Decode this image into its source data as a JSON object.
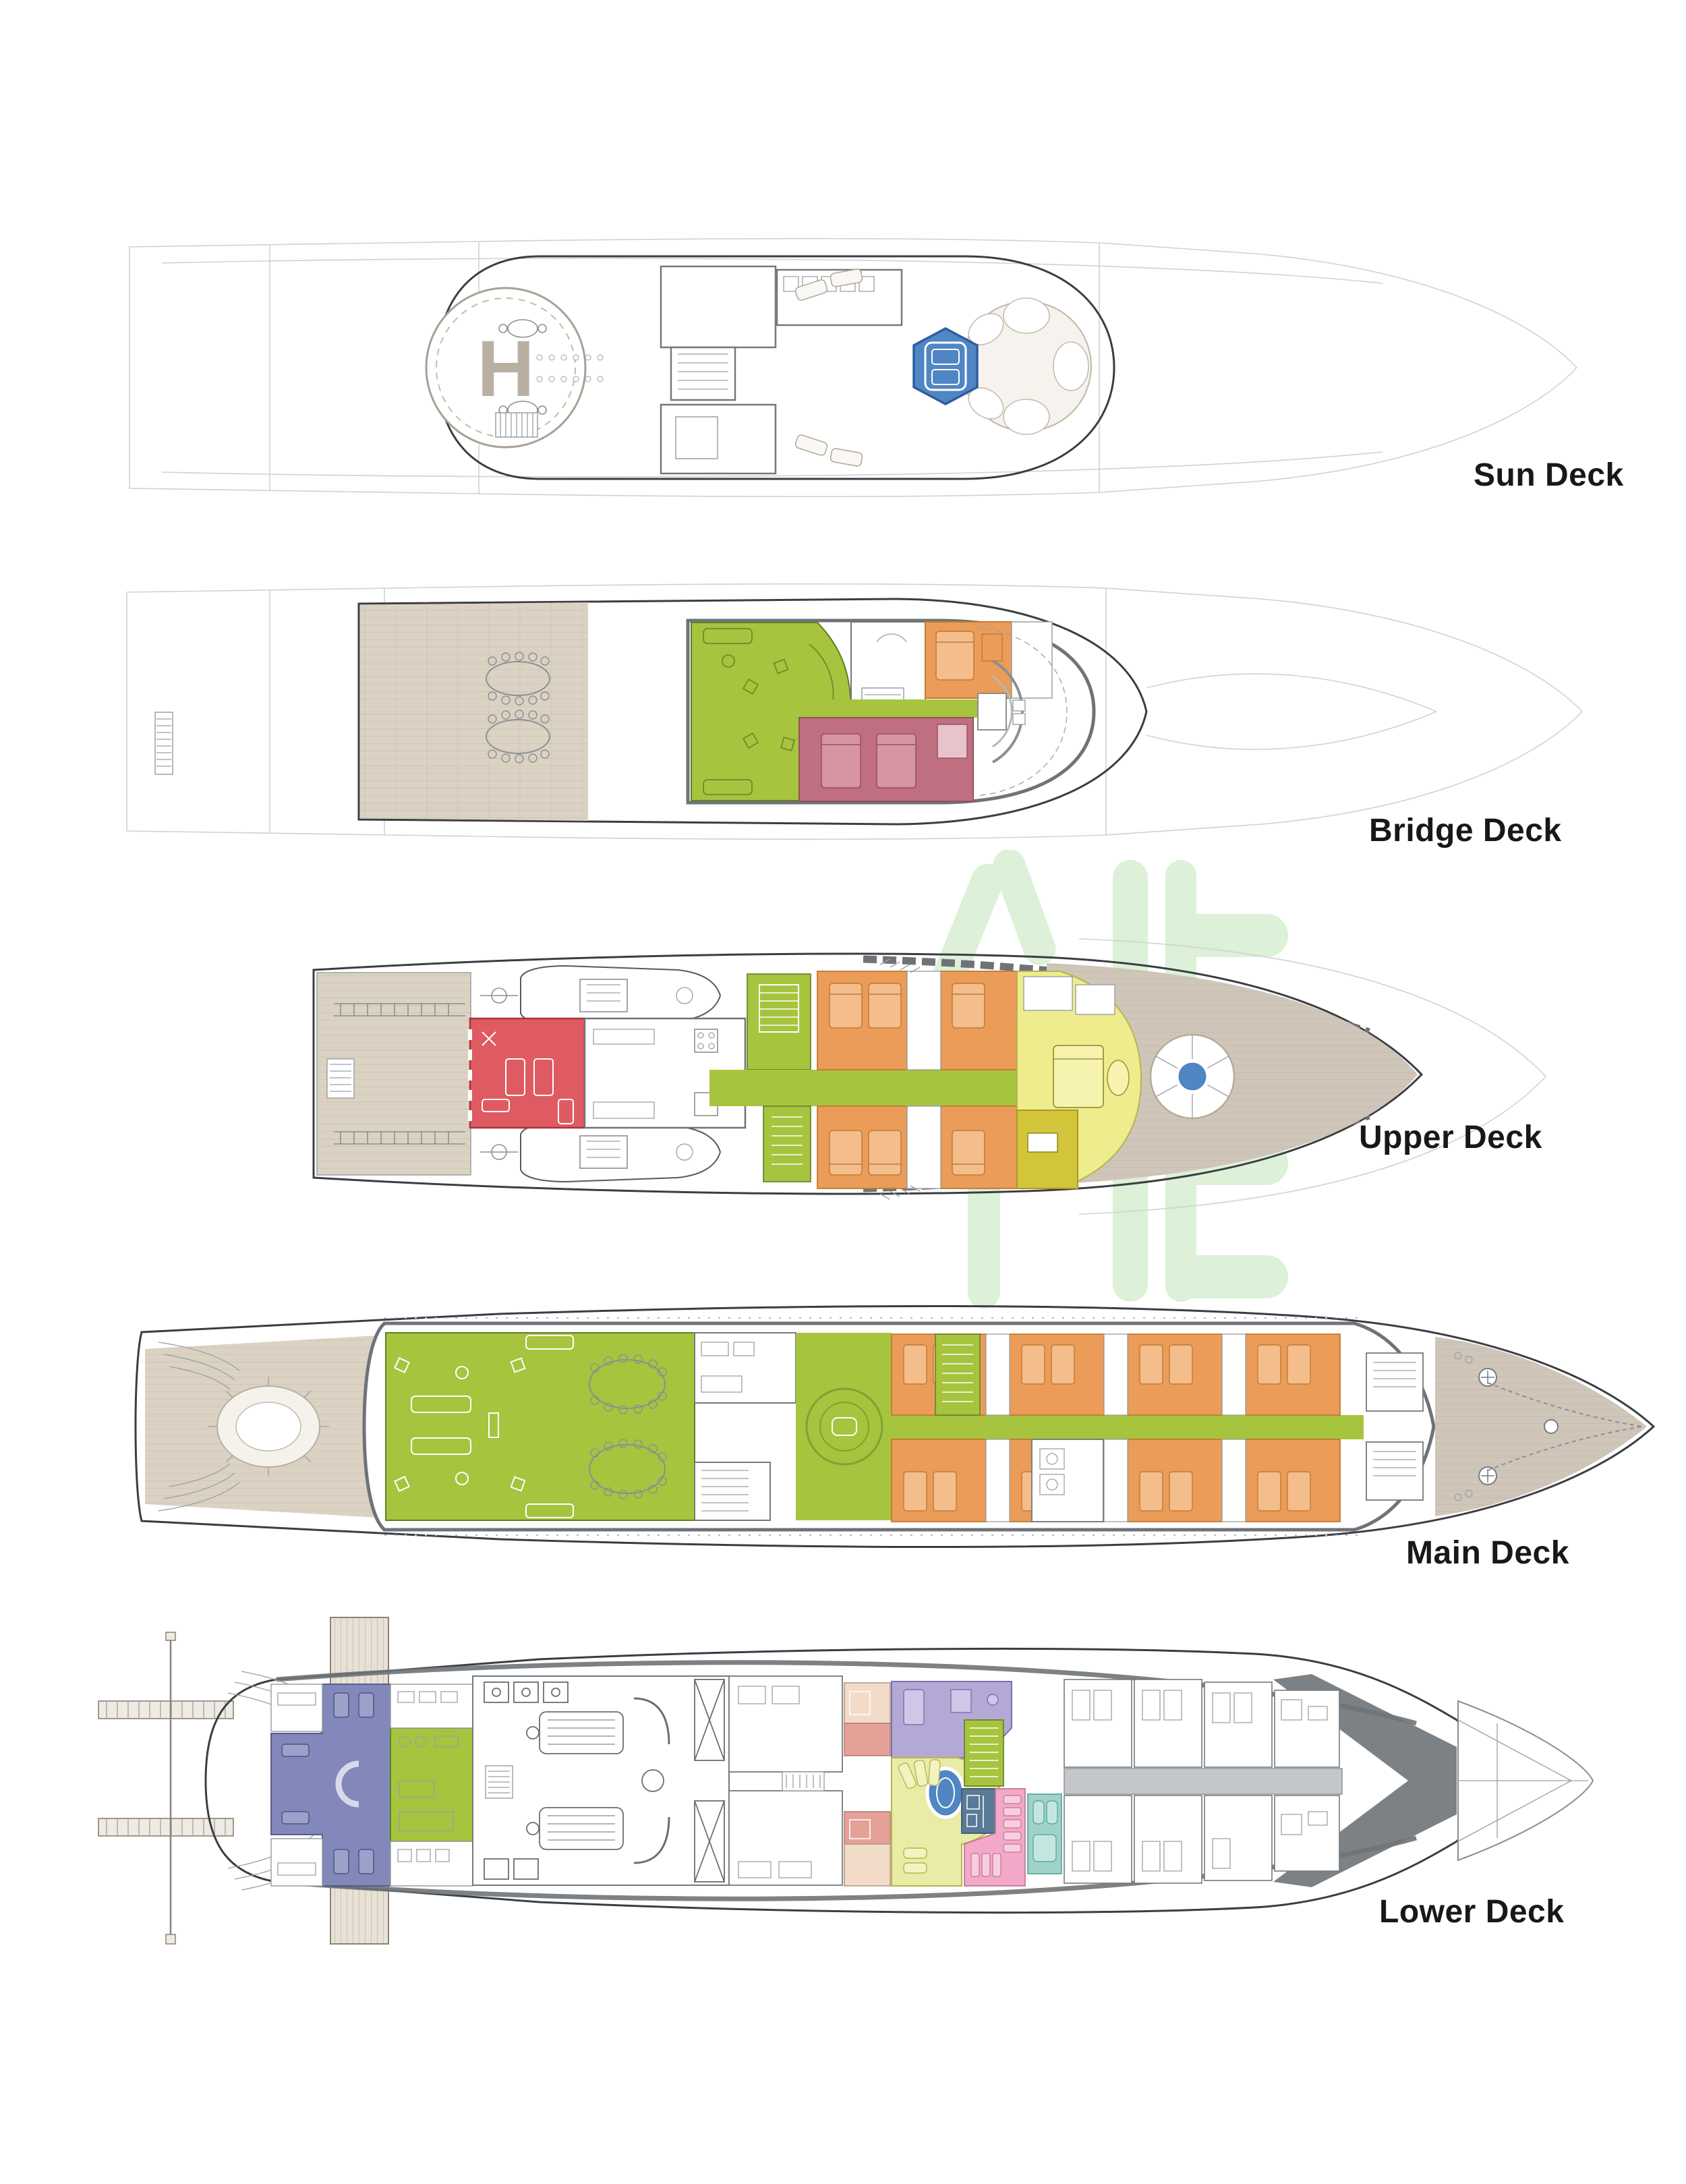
{
  "page": {
    "background": "#ffffff"
  },
  "watermark": {
    "color": "#dcf1d8"
  },
  "palette": {
    "label": "#17181a",
    "hull_line": "#3a3e42",
    "hull_faint": "#d2d2d2",
    "wall_gray": "#6e7378",
    "wood": "#dbd2c3",
    "wood_line": "#c7bcab",
    "wood_fore": "#cfc6b9",
    "green": "#a6c43e",
    "green_dark": "#5f7f27",
    "orange": "#eb9c58",
    "orange_light": "#f3bd8c",
    "orange_dark": "#c27a33",
    "red": "#e05a62",
    "rose": "#c06f80",
    "pale_yellow": "#efec8e",
    "dark_yellow": "#d2c53a",
    "spa_yellow": "#e9eca6",
    "lavender": "#b4a9d6",
    "pink": "#f2a9c9",
    "salmon": "#e5a198",
    "cream": "#f2dcc9",
    "teal": "#9fd2ca",
    "slate": "#5a7a97",
    "periwinkle": "#8289ba",
    "pool_blue": "#4f86c3",
    "pool_dark": "#2f5e9e"
  },
  "decks": [
    {
      "id": "sun",
      "label": "Sun Deck",
      "helipad_mark": "H"
    },
    {
      "id": "bridge",
      "label": "Bridge Deck"
    },
    {
      "id": "upper",
      "label": "Upper Deck"
    },
    {
      "id": "main",
      "label": "Main Deck"
    },
    {
      "id": "lower",
      "label": "Lower Deck"
    }
  ]
}
